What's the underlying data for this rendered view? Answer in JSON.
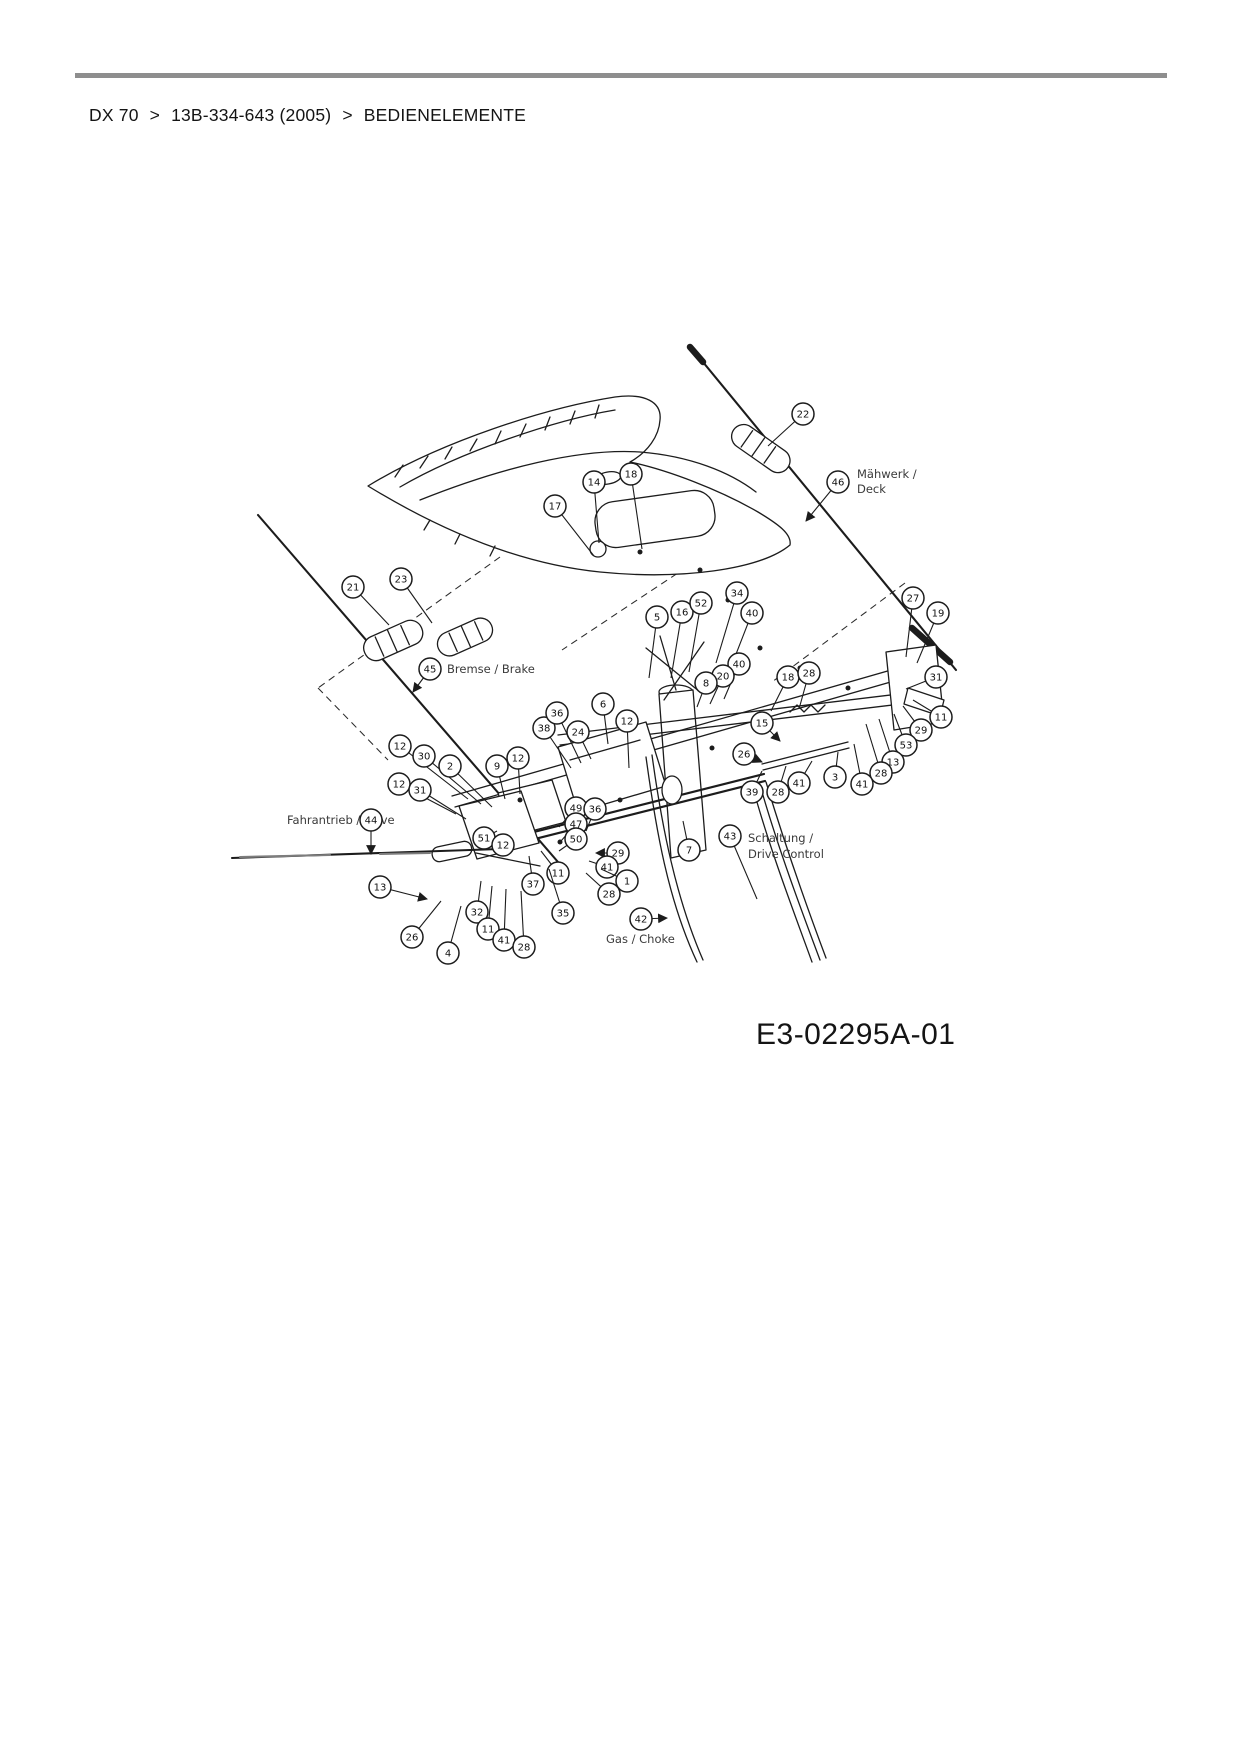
{
  "breadcrumb": {
    "items": [
      "DX 70",
      "13B-334-643 (2005)",
      "BEDIENELEMENTE"
    ],
    "separator": ">"
  },
  "diagram": {
    "code": "E3-02295A-01",
    "labels": [
      {
        "text": "Mähwerk /",
        "x": 857,
        "y": 478
      },
      {
        "text": "Deck",
        "x": 857,
        "y": 493
      },
      {
        "text": "Bremse / Brake",
        "x": 447,
        "y": 673
      },
      {
        "text": "Fahrantrieb / Drive",
        "x": 287,
        "y": 824
      },
      {
        "text": "Schaltung /",
        "x": 748,
        "y": 842
      },
      {
        "text": "Drive Control",
        "x": 748,
        "y": 858
      },
      {
        "text": "Gas / Choke",
        "x": 606,
        "y": 943
      }
    ],
    "callouts": [
      {
        "n": "22",
        "x": 803,
        "y": 414,
        "tx": 768,
        "ty": 446
      },
      {
        "n": "46",
        "x": 838,
        "y": 482,
        "tx": 806,
        "ty": 521,
        "a": 1
      },
      {
        "n": "17",
        "x": 555,
        "y": 506,
        "tx": 594,
        "ty": 556
      },
      {
        "n": "14",
        "x": 594,
        "y": 482,
        "tx": 599,
        "ty": 543
      },
      {
        "n": "18",
        "x": 631,
        "y": 474,
        "tx": 642,
        "ty": 549
      },
      {
        "n": "21",
        "x": 353,
        "y": 587,
        "tx": 389,
        "ty": 625
      },
      {
        "n": "23",
        "x": 401,
        "y": 579,
        "tx": 432,
        "ty": 623
      },
      {
        "n": "45",
        "x": 430,
        "y": 669,
        "tx": 413,
        "ty": 692,
        "a": 1
      },
      {
        "n": "5",
        "x": 657,
        "y": 617,
        "tx": 649,
        "ty": 678
      },
      {
        "n": "16",
        "x": 682,
        "y": 612,
        "tx": 671,
        "ty": 678
      },
      {
        "n": "52",
        "x": 701,
        "y": 603,
        "tx": 689,
        "ty": 672
      },
      {
        "n": "34",
        "x": 737,
        "y": 593,
        "tx": 716,
        "ty": 663
      },
      {
        "n": "40",
        "x": 752,
        "y": 613,
        "tx": 731,
        "ty": 667
      },
      {
        "n": "40",
        "x": 739,
        "y": 664,
        "tx": 724,
        "ty": 699
      },
      {
        "n": "20",
        "x": 723,
        "y": 676,
        "tx": 710,
        "ty": 704
      },
      {
        "n": "8",
        "x": 706,
        "y": 683,
        "tx": 697,
        "ty": 707
      },
      {
        "n": "18",
        "x": 788,
        "y": 677,
        "tx": 771,
        "ty": 711
      },
      {
        "n": "28",
        "x": 809,
        "y": 673,
        "tx": 799,
        "ty": 709
      },
      {
        "n": "15",
        "x": 762,
        "y": 723,
        "tx": 780,
        "ty": 741,
        "a": 1
      },
      {
        "n": "27",
        "x": 913,
        "y": 598,
        "tx": 906,
        "ty": 657
      },
      {
        "n": "19",
        "x": 938,
        "y": 613,
        "tx": 917,
        "ty": 663
      },
      {
        "n": "31",
        "x": 936,
        "y": 677,
        "tx": 906,
        "ty": 689
      },
      {
        "n": "11",
        "x": 941,
        "y": 717,
        "tx": 913,
        "ty": 700
      },
      {
        "n": "29",
        "x": 921,
        "y": 730,
        "tx": 903,
        "ty": 706
      },
      {
        "n": "53",
        "x": 906,
        "y": 745,
        "tx": 894,
        "ty": 714
      },
      {
        "n": "13",
        "x": 893,
        "y": 762,
        "tx": 879,
        "ty": 719
      },
      {
        "n": "28",
        "x": 881,
        "y": 773,
        "tx": 866,
        "ty": 724
      },
      {
        "n": "41",
        "x": 862,
        "y": 784,
        "tx": 854,
        "ty": 744
      },
      {
        "n": "3",
        "x": 835,
        "y": 777,
        "tx": 838,
        "ty": 752
      },
      {
        "n": "26",
        "x": 744,
        "y": 754,
        "tx": 762,
        "ty": 762,
        "a": 1
      },
      {
        "n": "41",
        "x": 799,
        "y": 783,
        "tx": 812,
        "ty": 761
      },
      {
        "n": "39",
        "x": 752,
        "y": 792,
        "tx": 762,
        "ty": 771
      },
      {
        "n": "28",
        "x": 778,
        "y": 792,
        "tx": 786,
        "ty": 766
      },
      {
        "n": "6",
        "x": 603,
        "y": 704,
        "tx": 608,
        "ty": 744
      },
      {
        "n": "24",
        "x": 578,
        "y": 732,
        "tx": 591,
        "ty": 759
      },
      {
        "n": "12",
        "x": 627,
        "y": 721,
        "tx": 629,
        "ty": 768
      },
      {
        "n": "38",
        "x": 544,
        "y": 728,
        "tx": 571,
        "ty": 768
      },
      {
        "n": "36",
        "x": 557,
        "y": 713,
        "tx": 581,
        "ty": 763
      },
      {
        "n": "12",
        "x": 400,
        "y": 746,
        "tx": 468,
        "ty": 799
      },
      {
        "n": "30",
        "x": 424,
        "y": 756,
        "tx": 481,
        "ty": 804
      },
      {
        "n": "2",
        "x": 450,
        "y": 766,
        "tx": 492,
        "ty": 807
      },
      {
        "n": "9",
        "x": 497,
        "y": 766,
        "tx": 505,
        "ty": 799
      },
      {
        "n": "12",
        "x": 518,
        "y": 758,
        "tx": 520,
        "ty": 794
      },
      {
        "n": "12",
        "x": 399,
        "y": 784,
        "tx": 456,
        "ty": 814
      },
      {
        "n": "31",
        "x": 420,
        "y": 790,
        "tx": 466,
        "ty": 819
      },
      {
        "n": "44",
        "x": 371,
        "y": 820,
        "tx": 371,
        "ty": 854,
        "a": 1
      },
      {
        "n": "51",
        "x": 484,
        "y": 838,
        "tx": 497,
        "ty": 831
      },
      {
        "n": "12",
        "x": 503,
        "y": 845,
        "tx": 506,
        "ty": 836
      },
      {
        "n": "13",
        "x": 380,
        "y": 887,
        "tx": 427,
        "ty": 899,
        "a": 1
      },
      {
        "n": "26",
        "x": 412,
        "y": 937,
        "tx": 441,
        "ty": 901
      },
      {
        "n": "4",
        "x": 448,
        "y": 953,
        "tx": 461,
        "ty": 906
      },
      {
        "n": "32",
        "x": 477,
        "y": 912,
        "tx": 481,
        "ty": 881
      },
      {
        "n": "11",
        "x": 488,
        "y": 929,
        "tx": 492,
        "ty": 886
      },
      {
        "n": "41",
        "x": 504,
        "y": 940,
        "tx": 506,
        "ty": 889
      },
      {
        "n": "28",
        "x": 524,
        "y": 947,
        "tx": 521,
        "ty": 891
      },
      {
        "n": "37",
        "x": 533,
        "y": 884,
        "tx": 529,
        "ty": 856
      },
      {
        "n": "11",
        "x": 558,
        "y": 873,
        "tx": 541,
        "ty": 851
      },
      {
        "n": "35",
        "x": 563,
        "y": 913,
        "tx": 549,
        "ty": 869
      },
      {
        "n": "49",
        "x": 576,
        "y": 808,
        "tx": 559,
        "ty": 827
      },
      {
        "n": "36",
        "x": 595,
        "y": 809,
        "tx": 586,
        "ty": 831
      },
      {
        "n": "47",
        "x": 576,
        "y": 824,
        "tx": 561,
        "ty": 841
      },
      {
        "n": "50",
        "x": 576,
        "y": 839,
        "tx": 559,
        "ty": 851
      },
      {
        "n": "29",
        "x": 618,
        "y": 853,
        "tx": 596,
        "ty": 853,
        "a": 1
      },
      {
        "n": "41",
        "x": 607,
        "y": 867,
        "tx": 589,
        "ty": 861
      },
      {
        "n": "1",
        "x": 627,
        "y": 881,
        "tx": 601,
        "ty": 869
      },
      {
        "n": "28",
        "x": 609,
        "y": 894,
        "tx": 586,
        "ty": 873
      },
      {
        "n": "7",
        "x": 689,
        "y": 850,
        "tx": 683,
        "ty": 821
      },
      {
        "n": "43",
        "x": 730,
        "y": 836,
        "tx": 757,
        "ty": 899
      },
      {
        "n": "42",
        "x": 641,
        "y": 919,
        "tx": 667,
        "ty": 918,
        "a": 1
      }
    ]
  }
}
